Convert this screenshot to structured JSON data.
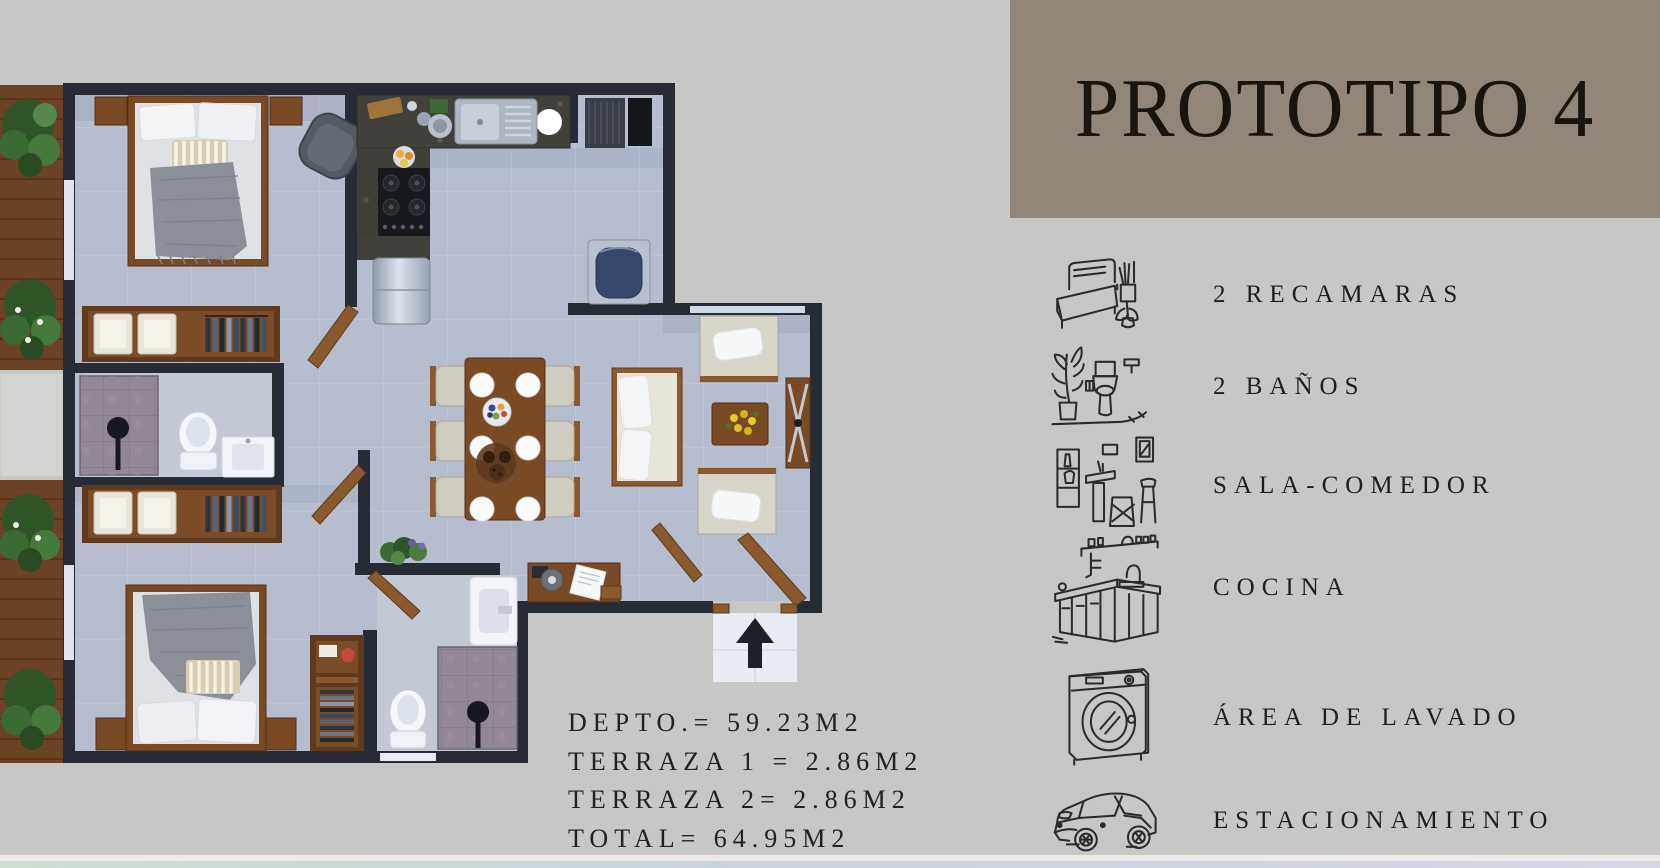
{
  "title": "PROTOTIPO 4",
  "features": [
    {
      "icon": "bed-icon",
      "label": "2 RECAMARAS"
    },
    {
      "icon": "toilet-icon",
      "label": "2 BAÑOS"
    },
    {
      "icon": "living-dining-icon",
      "label": "SALA-COMEDOR"
    },
    {
      "icon": "kitchen-icon",
      "label": "COCINA"
    },
    {
      "icon": "washer-icon",
      "label": "ÁREA DE LAVADO"
    },
    {
      "icon": "car-icon",
      "label": "ESTACIONAMIENTO"
    }
  ],
  "measurements": [
    "DEPTO.= 59.23M2",
    "TERRAZA 1 = 2.86M2",
    "TERRAZA 2= 2.86M2",
    "TOTAL= 64.95M2"
  ],
  "colors": {
    "panel": "#918679",
    "background": "#c7c7c6",
    "walls": "#262b36",
    "floor": "#b6bdce",
    "text": "#1f1e1c"
  }
}
